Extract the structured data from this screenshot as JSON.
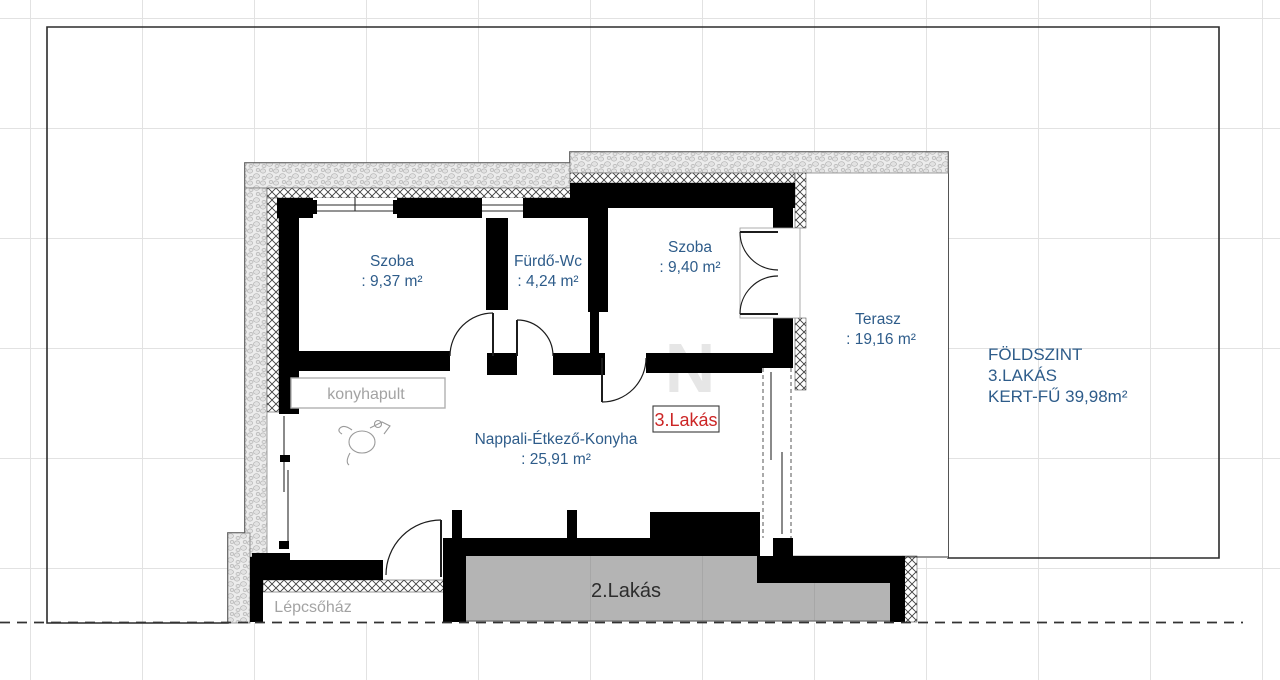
{
  "plan": {
    "unit_badge": "3.Lakás",
    "watermark": "N",
    "rooms": [
      {
        "name": "Szoba",
        "area": ": 9,37 m²"
      },
      {
        "name": "Fürdő-Wc",
        "area": ": 4,24 m²"
      },
      {
        "name": "Szoba",
        "area": ": 9,40 m²"
      },
      {
        "name": "Terasz",
        "area": ": 19,16 m²"
      },
      {
        "name": "Nappali-Étkező-Konyha",
        "area": ": 25,91 m²"
      }
    ],
    "annotations": {
      "konyhapult": "konyhapult",
      "stairwell": "Lépcsőház",
      "unit2": "2.Lakás"
    },
    "legend": {
      "line1": "FÖLDSZINT",
      "line2": "3.LAKÁS",
      "line3": "KERT-FŰ 39,98m²"
    },
    "colors": {
      "room_label": "#2e5c8a",
      "badge_text": "#cc2626",
      "wall": "#000000",
      "unit2_fill": "#b4b4b4",
      "muted_label": "#a3a3a3",
      "grass_mark": "#b9b9b9"
    }
  }
}
